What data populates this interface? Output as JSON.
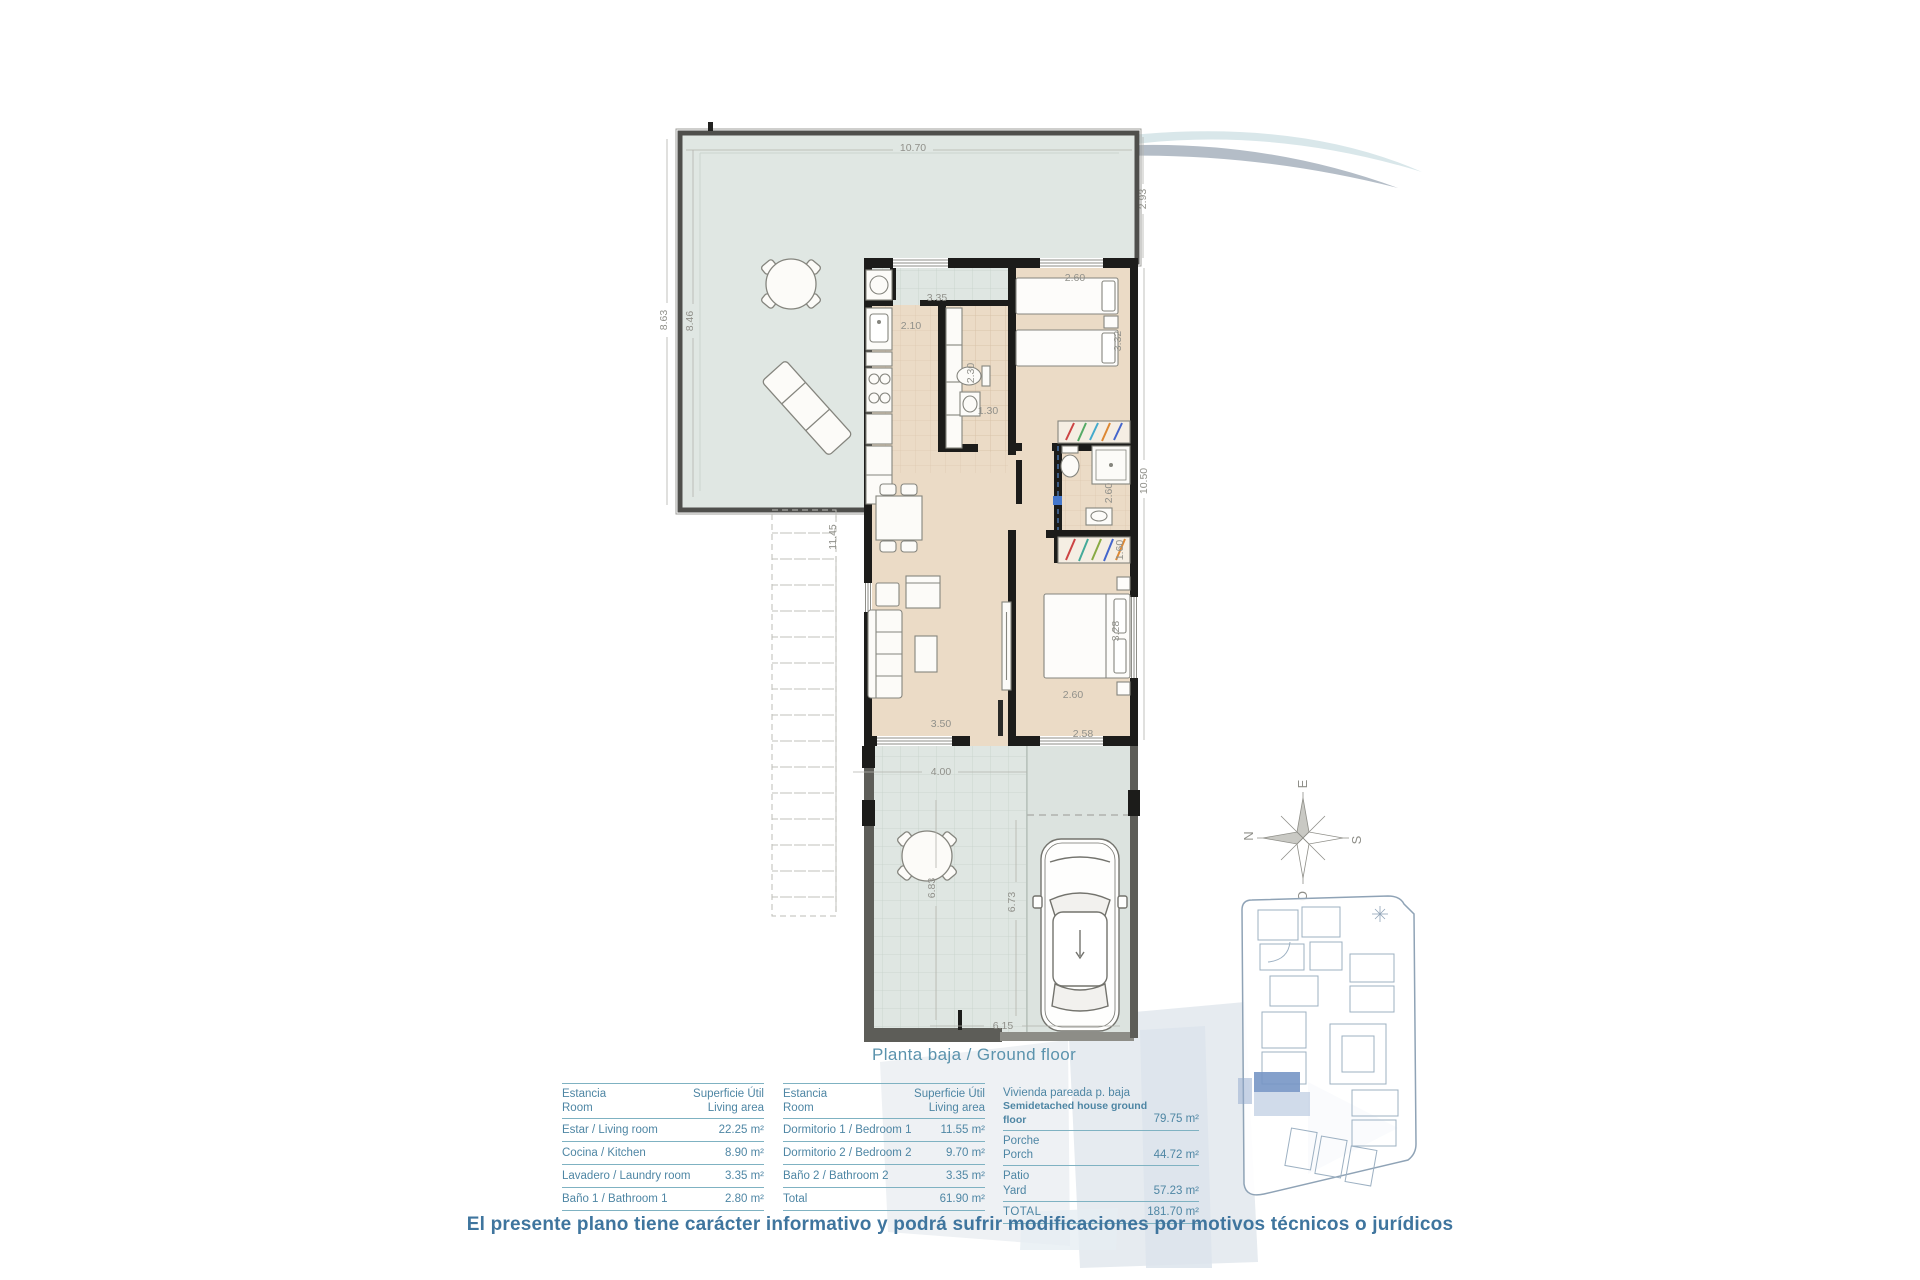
{
  "title": "Planta baja / Ground floor",
  "disclaimer": "El presente plano tiene carácter informativo y podrá sufrir modificaciones por motivos técnicos o jurídicos",
  "colors": {
    "accent_text": "#4e86a4",
    "rule": "#7fb2c2",
    "caption": "#5b93ad",
    "disclaimer": "#3f759e",
    "wall": "#1c1c1a",
    "interior_floor": "#ebdbc6",
    "terrace": "#e0e7e3",
    "highlight_unit": "#7796c5"
  },
  "compass": {
    "north": "N",
    "south": "S",
    "east": "E",
    "west": "O"
  },
  "plan": {
    "dims": [
      "10.70",
      "2.93",
      "8.63",
      "8.46",
      "11.45",
      "3.35",
      "2.10",
      "1.30",
      "2.60",
      "3.32",
      "10.50",
      "2.60",
      "1.60",
      "2.30",
      "2.60",
      "3.28",
      "3.50",
      "4.00",
      "2.58",
      "6.83",
      "6.73",
      "6.15"
    ]
  },
  "tables": {
    "t1": {
      "header": {
        "c1a": "Estancia",
        "c1b": "Room",
        "c2a": "Superficie Útil",
        "c2b": "Living area"
      },
      "rows": [
        {
          "label": "Estar / Living room",
          "value": "22.25 m²"
        },
        {
          "label": "Cocina / Kitchen",
          "value": "8.90 m²"
        },
        {
          "label": "Lavadero / Laundry room",
          "value": "3.35 m²"
        },
        {
          "label": "Baño 1 / Bathroom 1",
          "value": "2.80 m²"
        }
      ]
    },
    "t2": {
      "header": {
        "c1a": "Estancia",
        "c1b": "Room",
        "c2a": "Superficie Útil",
        "c2b": "Living area"
      },
      "rows": [
        {
          "label": "Dormitorio 1 / Bedroom 1",
          "value": "11.55 m²"
        },
        {
          "label": "Dormitorio 2 / Bedroom 2",
          "value": "9.70 m²"
        },
        {
          "label": "Baño 2 / Bathroom 2",
          "value": "3.35 m²"
        },
        {
          "label": "Total",
          "value": "61.90 m²"
        }
      ]
    },
    "t3": {
      "rows": [
        {
          "es": "Vivienda pareada p. baja",
          "en": "Semidetached house ground floor",
          "value": "79.75 m²"
        },
        {
          "es": "Porche",
          "en": "Porch",
          "value": "44.72 m²"
        },
        {
          "es": "Patio",
          "en": "Yard",
          "value": "57.23 m²"
        },
        {
          "es": "TOTAL",
          "en": "",
          "value": "181.70 m²"
        }
      ]
    }
  }
}
